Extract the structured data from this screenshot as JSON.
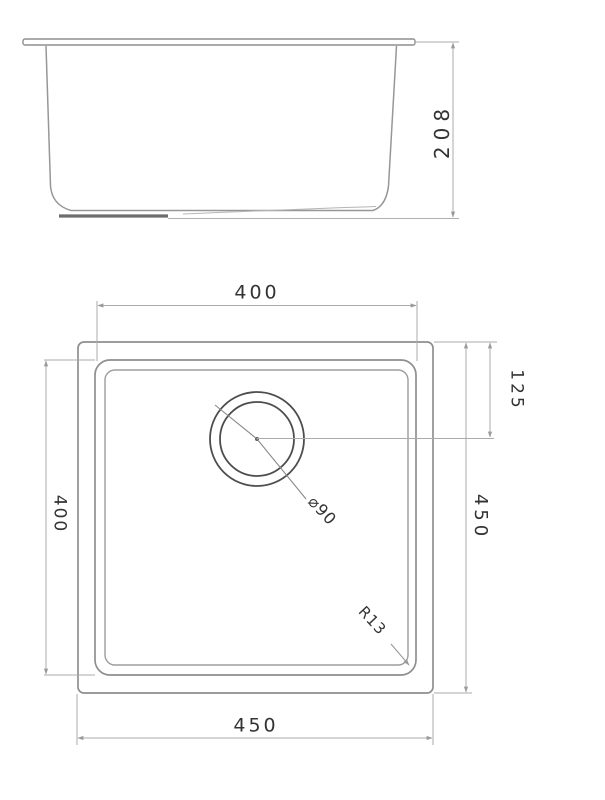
{
  "side_view": {
    "height": "208"
  },
  "plan_view": {
    "top_width": "400",
    "left_height": "400",
    "bottom_width": "450",
    "right_height": "450",
    "drain_center_offset": "125",
    "drain_diameter": "⌀90",
    "corner_radius": "R13"
  },
  "colors": {
    "object_line": "#909090",
    "dimension_line": "#ababab",
    "drain_line": "#4d4d4d",
    "drain_boss_line": "#6d6d6d",
    "text": "#333333",
    "background": "#ffffff"
  }
}
